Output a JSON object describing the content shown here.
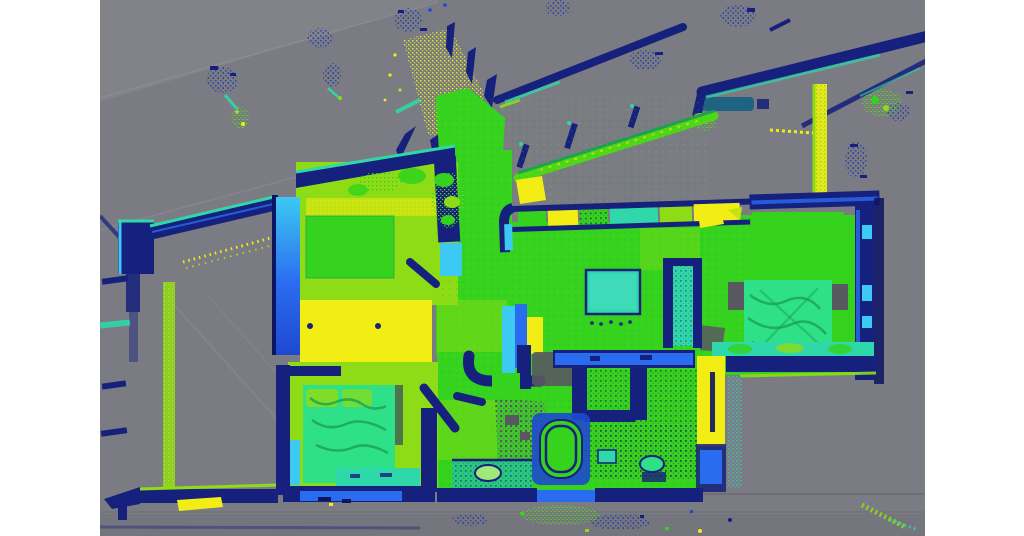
{
  "meta": {
    "content_type": "lidar-point-cloud-render",
    "view": "top-down-floor-plan",
    "has_visible_text": false
  },
  "canvas": {
    "width": 1024,
    "height": 536,
    "letterbox_left_px": 100,
    "letterbox_right_px": 99
  },
  "palette": {
    "white": "#ffffff",
    "bg": "#7b7c83",
    "bg_light": "#87878d",
    "bg_dark": "#74747c",
    "line_faint": "#8e8e96",
    "ground_line": "#6d6d75",
    "navy": "#16207d",
    "navy_deep": "#0d1560",
    "blue": "#1e49cf",
    "blue_bright": "#2a6cf0",
    "cyan": "#3cc9f2",
    "teal": "#2fd8a8",
    "spring": "#2ee087",
    "green": "#35d31d",
    "green_dark": "#1da052",
    "lime": "#8edc16",
    "ygreen": "#c4e312",
    "yellow": "#f2ee15",
    "gray_shadow": "#585860"
  },
  "regions": [
    "terrace",
    "bedroom-top-left",
    "bedroom-bottom-left",
    "entry-hall",
    "living-room",
    "kitchen-strip",
    "bedroom-right",
    "bathroom",
    "exterior-wall-beams",
    "scan-noise-clusters"
  ]
}
